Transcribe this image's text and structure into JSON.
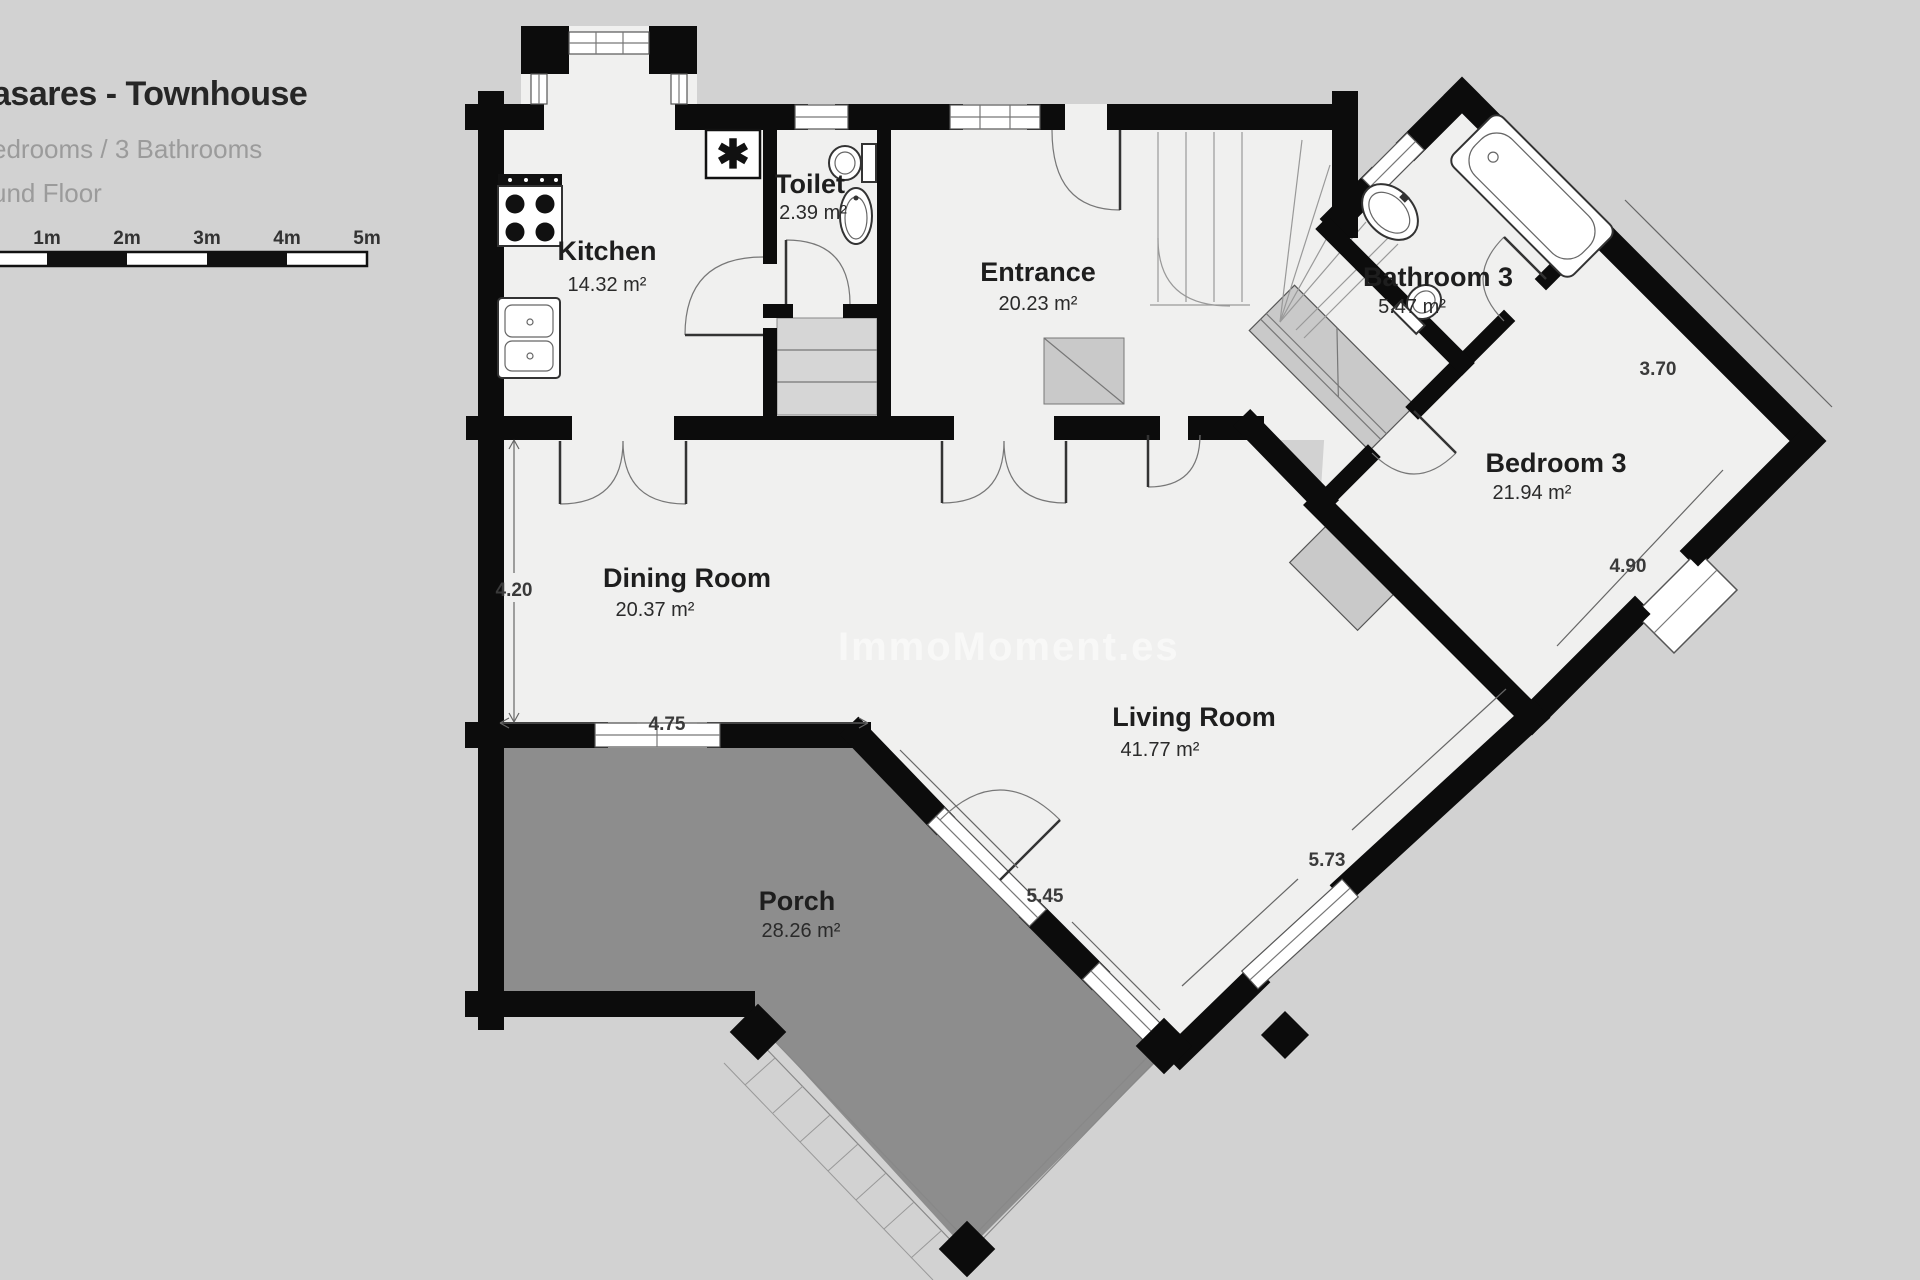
{
  "header": {
    "title": "asares - Townhouse",
    "subtitle": "edrooms / 3 Bathrooms",
    "floor_label": "und Floor"
  },
  "scale_bar": {
    "labels": [
      "1m",
      "2m",
      "3m",
      "4m",
      "5m"
    ]
  },
  "watermark": "ImmoMoment.es",
  "rooms": [
    {
      "name": "Kitchen",
      "area": "14.32 m²"
    },
    {
      "name": "Toilet",
      "area": "2.39 m²"
    },
    {
      "name": "Entrance",
      "area": "20.23 m²"
    },
    {
      "name": "Bathroom 3",
      "area": "5.47 m²"
    },
    {
      "name": "Bedroom 3",
      "area": "21.94 m²"
    },
    {
      "name": "Dining Room",
      "area": "20.37 m²"
    },
    {
      "name": "Living Room",
      "area": "41.77 m²"
    },
    {
      "name": "Porch",
      "area": "28.26 m²"
    }
  ],
  "dimensions": {
    "dining_height": "4.20",
    "dining_width": "4.75",
    "living_porch": "5.45",
    "living_right": "5.73",
    "bedroom_top": "3.70",
    "bedroom_side": "4.90"
  },
  "symbols": {
    "boiler": "✱"
  },
  "colors": {
    "background": "#d2d2d2",
    "floor": "#f0f0ef",
    "porch": "#8d8d8d",
    "wall": "#0c0c0c",
    "closet_gray": "#c9c9c9"
  }
}
